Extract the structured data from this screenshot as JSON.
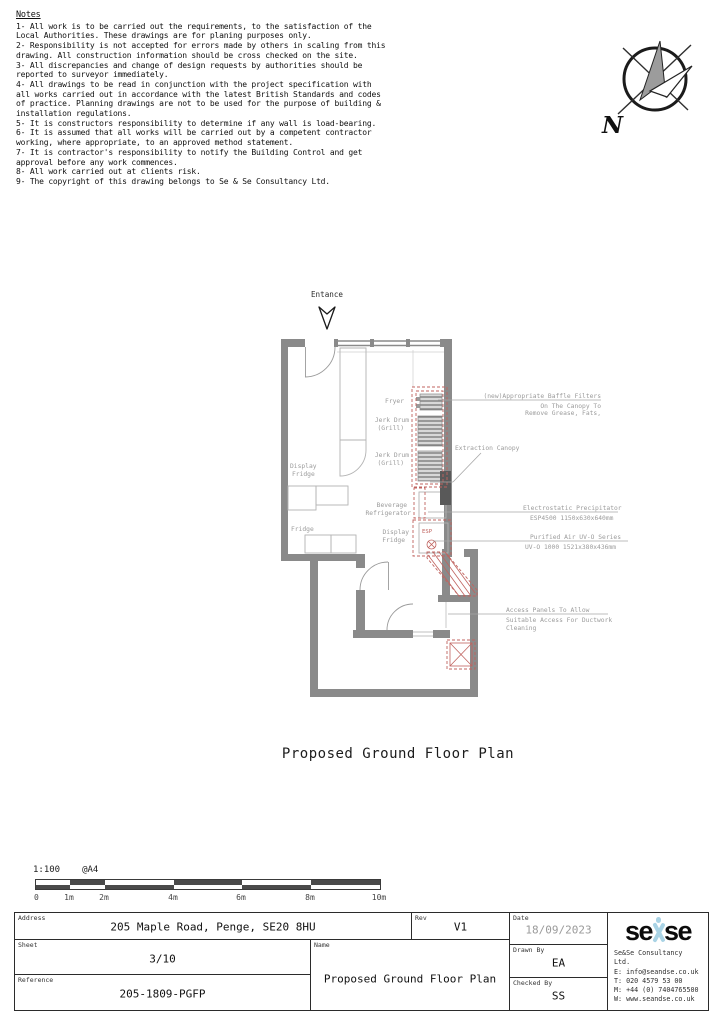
{
  "notes": {
    "title": "Notes",
    "items": [
      "1- All work is to be carried out the requirements, to the satisfaction of the Local Authorities. These drawings are for planing purposes only.",
      "2- Responsibility is not accepted for errors made by others in scaling from this drawing. All construction information should be cross checked on the site.",
      "3- All discrepancies and change of design requests by authorities should be reported to surveyor immediately.",
      "4- All drawings to be read in conjunction with the project specification with all works carried out in accordance with the latest British Standards and codes of practice. Planning drawings are not to be used for the purpose of building & installation regulations.",
      "5- It is constructors responsibility to determine if any wall is load-bearing.",
      "6- It is assumed that all works will be carried out by a competent contractor working, where appropriate, to an approved method statement.",
      "7- It is contractor's responsibility to notify the Building Control and get approval before any work commences.",
      "8- All work carried out at clients risk.",
      "9- The copyright of this drawing belongs to Se & Se Consultancy Ltd."
    ]
  },
  "north_arrow": {
    "label": "N"
  },
  "plan": {
    "entrance_label": "Entance",
    "labels": {
      "display_fridge_line1": "Display",
      "display_fridge_line2": "Fridge",
      "fridge": "Fridge",
      "fryer": "Fryer",
      "jerk_drum_1_line1": "Jerk Drum",
      "jerk_drum_1_line2": "(Grill)",
      "jerk_drum_2_line1": "Jerk Drum",
      "jerk_drum_2_line2": "(Grill)",
      "beverage_line1": "Beverage",
      "beverage_line2": "Refrigerator",
      "display2_line1": "Display",
      "display2_line2": "Fridge",
      "esp": "ESP"
    },
    "annotations": {
      "baffle_line1": "(new)Appropriate Baffle Filters",
      "baffle_line2": "On The Canopy To",
      "baffle_line3": "Remove Grease, Fats,",
      "extraction_canopy": "Extraction Canopy",
      "precipitator_line1": "Electrostatic Precipitator",
      "precipitator_line2": "ESP4500 1150x630x640mm",
      "uv_line1": "Purified Air UV-O Series",
      "uv_line2": "UV-O 1000 1521x380x436mm",
      "access_line1": "Access Panels To Allow",
      "access_line2": "Suitable Access For Ductwork",
      "access_line3": "Cleaning"
    }
  },
  "drawing_title": "Proposed Ground Floor Plan",
  "scale_bar": {
    "scale": "1:100",
    "paper": "@A4",
    "ticks": [
      "0",
      "1m",
      "2m",
      "4m",
      "6m",
      "8m",
      "10m"
    ]
  },
  "title_block": {
    "address_label": "Address",
    "address": "205 Maple Road, Penge, SE20 8HU",
    "rev_label": "Rev",
    "rev": "V1",
    "date_label": "Date",
    "date": "18/09/2023",
    "sheet_label": "Sheet",
    "sheet": "3/10",
    "name_label": "Name",
    "name": "Proposed Ground Floor Plan",
    "reference_label": "Reference",
    "reference": "205-1809-PGFP",
    "drawn_label": "Drawn By",
    "drawn": "EA",
    "checked_label": "Checked By",
    "checked": "SS",
    "company": {
      "logo_left": "se",
      "logo_right": "se",
      "name": "Se&Se Consultancy Ltd.",
      "email": "E: info@seandse.co.uk",
      "phone": "T: 020 4579 53 00",
      "mobile": "M: +44 (0) 7404765500",
      "website": "W: www.seandse.co.uk"
    }
  },
  "colors": {
    "wall": "#8a8a8a",
    "equipment_red": "#c0635f",
    "logo_blue": "#a9d3e5"
  }
}
